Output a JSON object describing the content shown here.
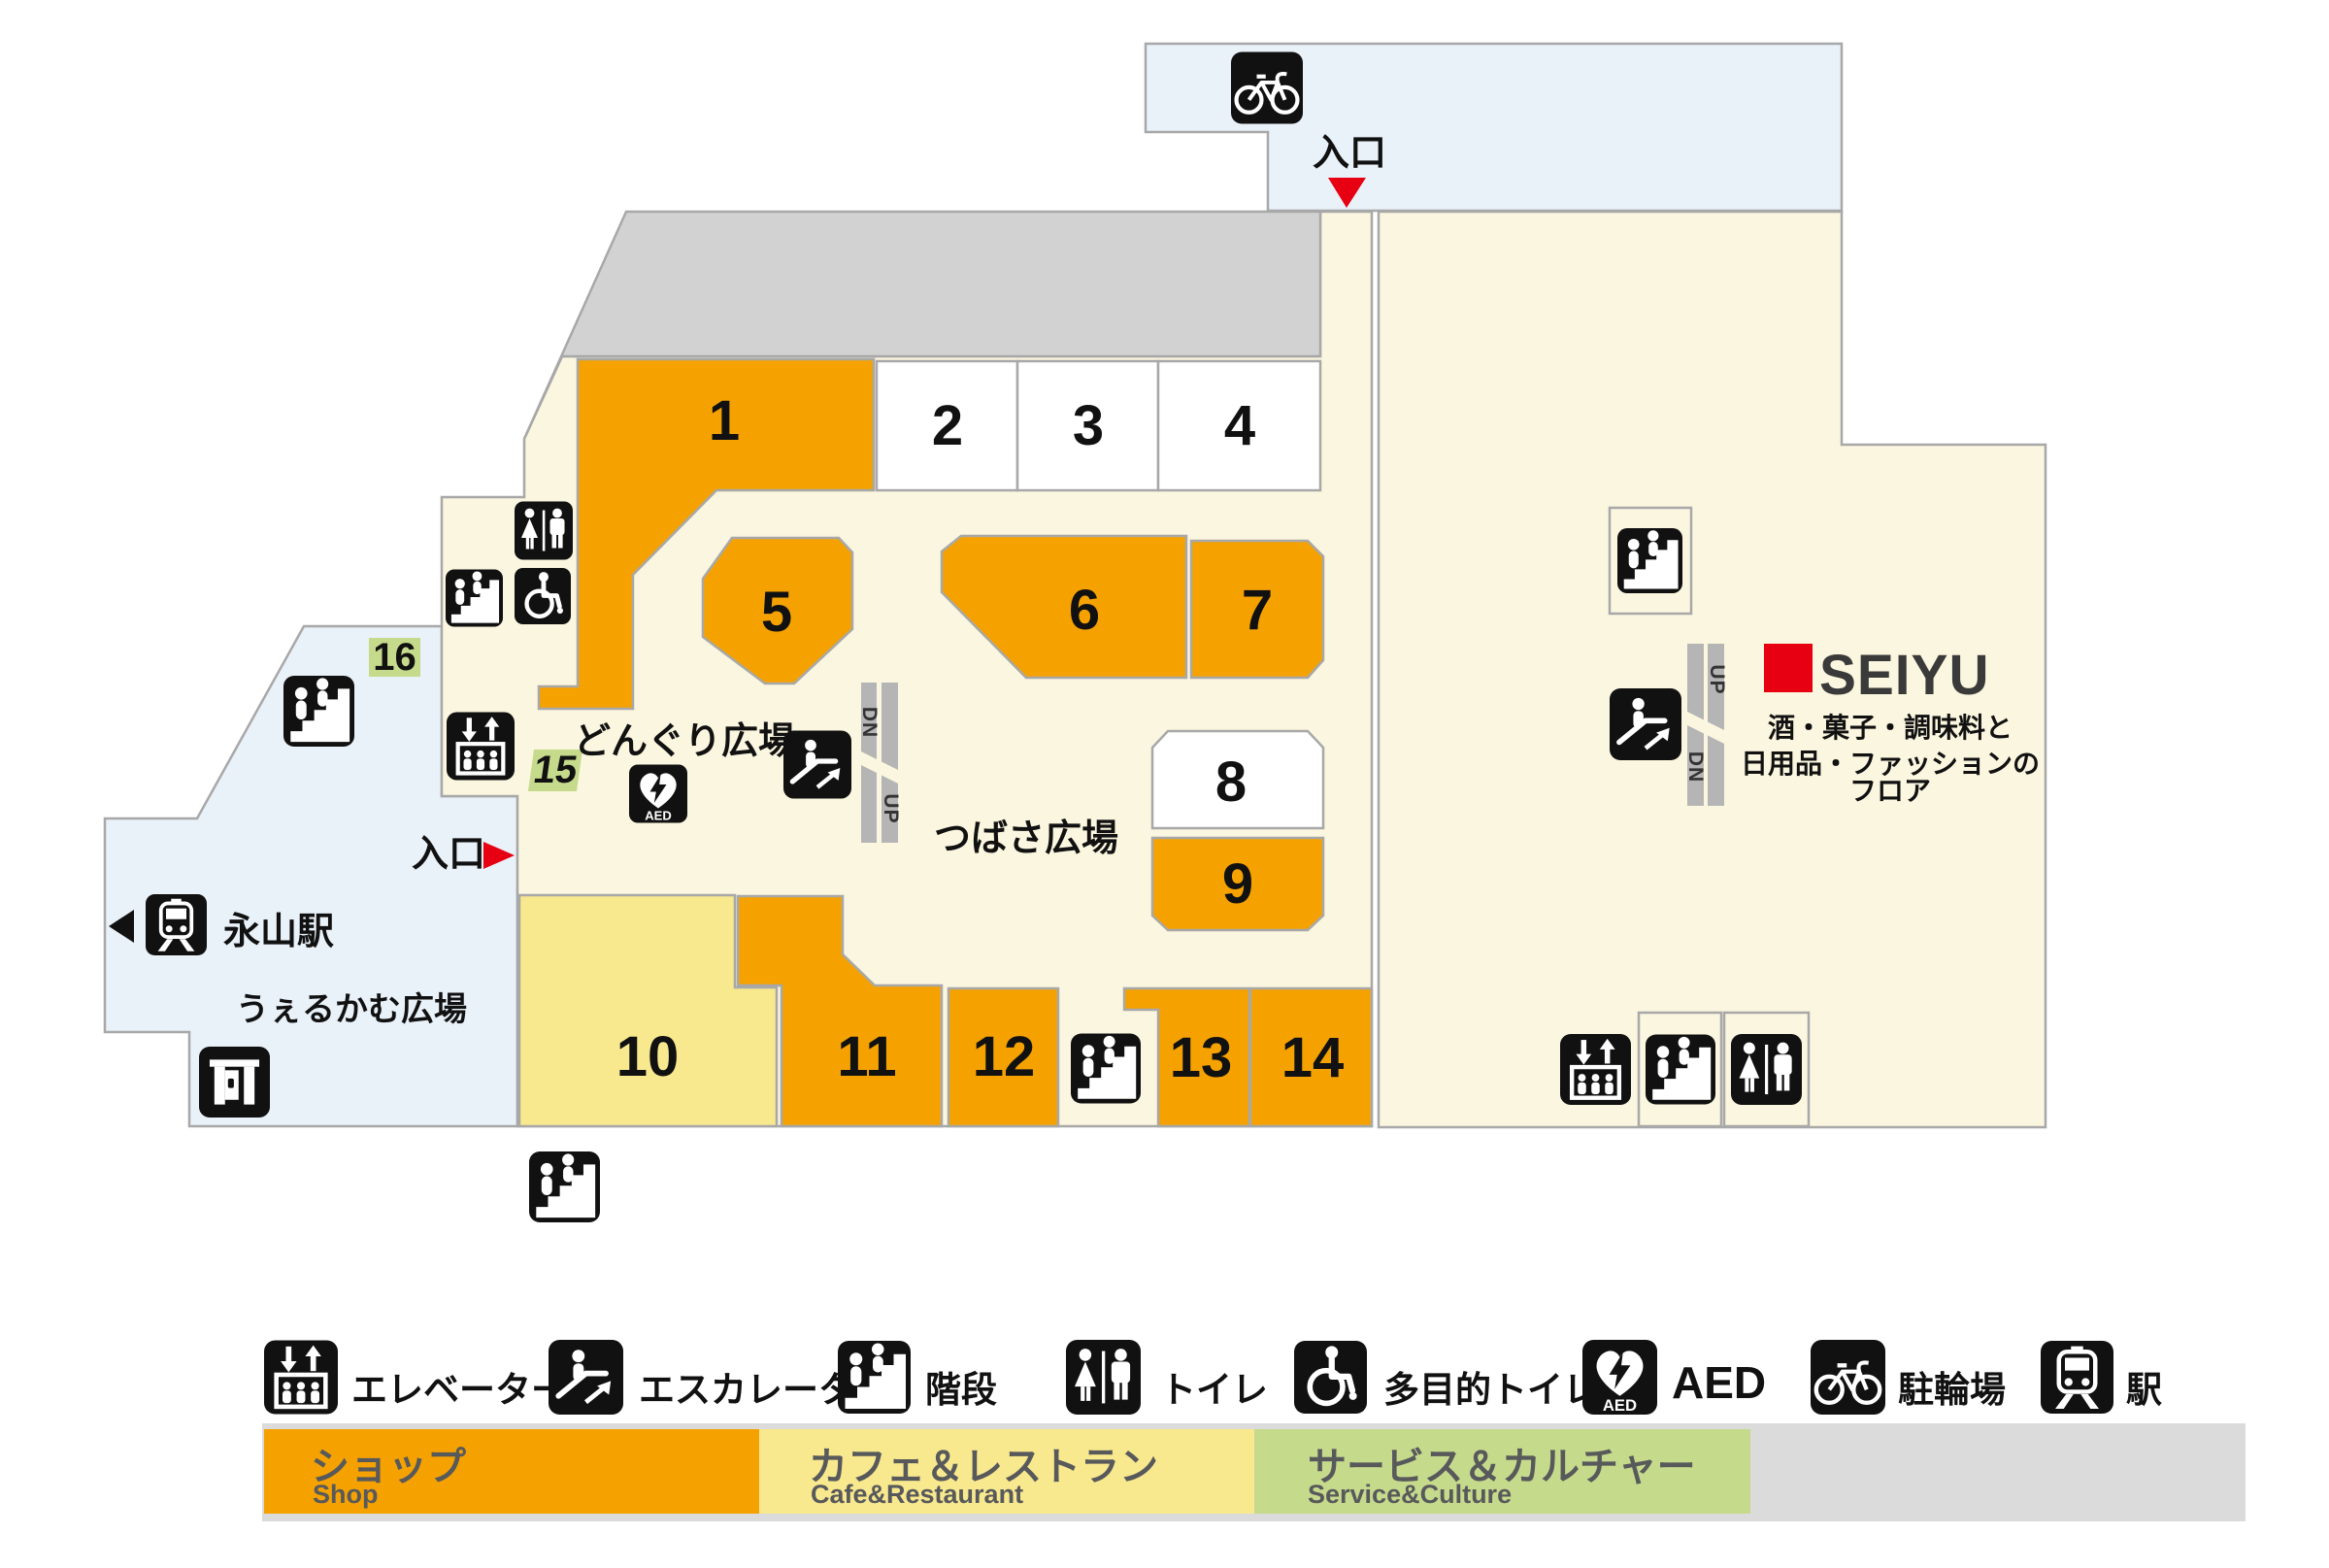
{
  "map": {
    "units": [
      {
        "no": "1",
        "type": "shop"
      },
      {
        "no": "2",
        "type": "vacant"
      },
      {
        "no": "3",
        "type": "vacant"
      },
      {
        "no": "4",
        "type": "vacant"
      },
      {
        "no": "5",
        "type": "shop"
      },
      {
        "no": "6",
        "type": "shop"
      },
      {
        "no": "7",
        "type": "shop"
      },
      {
        "no": "8",
        "type": "vacant"
      },
      {
        "no": "9",
        "type": "shop"
      },
      {
        "no": "10",
        "type": "cafe"
      },
      {
        "no": "11",
        "type": "shop"
      },
      {
        "no": "12",
        "type": "shop"
      },
      {
        "no": "13",
        "type": "shop"
      },
      {
        "no": "14",
        "type": "shop"
      },
      {
        "no": "15",
        "type": "service"
      },
      {
        "no": "16",
        "type": "service"
      }
    ],
    "labels": {
      "entrance_top": "入口",
      "entrance_left": "入口",
      "donguri_plaza": "どんぐり広場",
      "tsubasa_plaza": "つばさ広場",
      "welcome_plaza": "うぇるかむ広場",
      "station": "永山駅",
      "up": "UP",
      "dn": "DN"
    },
    "seiyu": {
      "name": "SEIYU",
      "desc1": "酒・菓子・調味料と",
      "desc2": "日用品・ファッションの",
      "desc3": "フロア"
    },
    "colors": {
      "shop": "#F5A200",
      "cafe": "#F8E88E",
      "service": "#C6DA8C",
      "floor": "#FBF6DF",
      "plaza_blue": "#E9F1F9",
      "roof_gray": "#D2D2D2",
      "accent_red": "#E60012"
    }
  },
  "legend": {
    "aed_icon_text": "AED",
    "items": [
      {
        "icon": "elevator-icon",
        "label": "エレベーター"
      },
      {
        "icon": "escalator-icon",
        "label": "エスカレーター"
      },
      {
        "icon": "stairs-icon",
        "label": "階段"
      },
      {
        "icon": "toilet-icon",
        "label": "トイレ"
      },
      {
        "icon": "accessible-toilet-icon",
        "label": "多目的トイレ"
      },
      {
        "icon": "aed-icon",
        "label": "AED"
      },
      {
        "icon": "bicycle-icon",
        "label": "駐輪場"
      },
      {
        "icon": "station-icon",
        "label": "駅"
      }
    ],
    "categories": [
      {
        "label": "ショップ",
        "sub": "Shop",
        "color": "#F5A200"
      },
      {
        "label": "カフェ＆レストラン",
        "sub": "Cafe&Restaurant",
        "color": "#F8E88E"
      },
      {
        "label": "サービス＆カルチャー",
        "sub": "Service&Culture",
        "color": "#C6DA8C"
      }
    ]
  }
}
